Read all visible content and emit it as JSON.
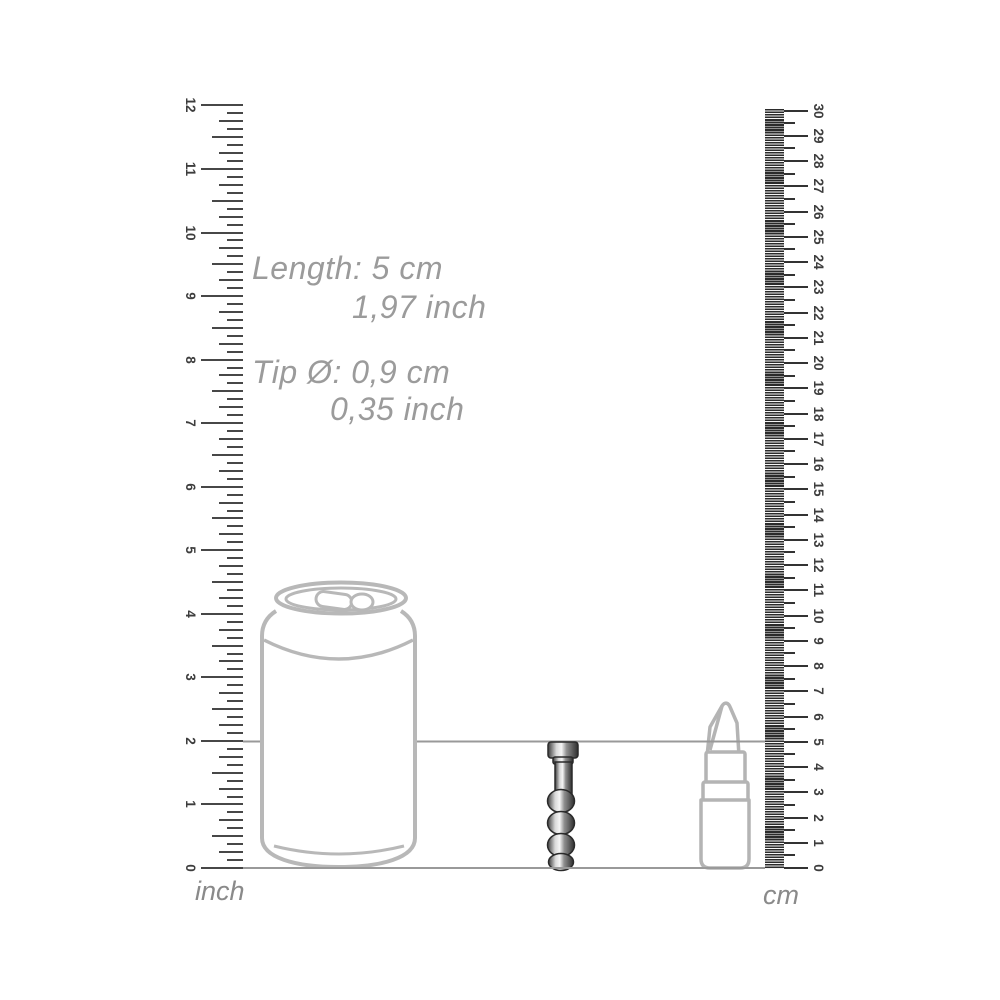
{
  "page": {
    "background": "#ffffff",
    "description": "Product size guide diagram with inch and cm rulers"
  },
  "annotations": {
    "length_metric": "Length: 5 cm",
    "length_imperial": "1,97 inch",
    "tip_metric": "Tip Ø: 0,9 cm",
    "tip_imperial": "0,35 inch",
    "text_color": "#9b9b9b"
  },
  "inch_ruler": {
    "unit_label": "inch",
    "min": 0,
    "max": 12,
    "subdivisions_per_unit": 8,
    "tick_color": "#474747"
  },
  "cm_ruler": {
    "unit_label": "cm",
    "min": 0,
    "max": 30,
    "tick_color": "#333333",
    "band_color": "#2b2b2b"
  },
  "reference_lines": {
    "baseline_value": "0",
    "upper_line_value": "5 cm / 2 inch",
    "line_color": "#999999"
  },
  "objects": {
    "can": "soda can (scale reference)",
    "product": "metal beaded plug (5 cm)",
    "lipstick": "lipstick (scale reference)",
    "outline_color": "#b8b8b8"
  }
}
